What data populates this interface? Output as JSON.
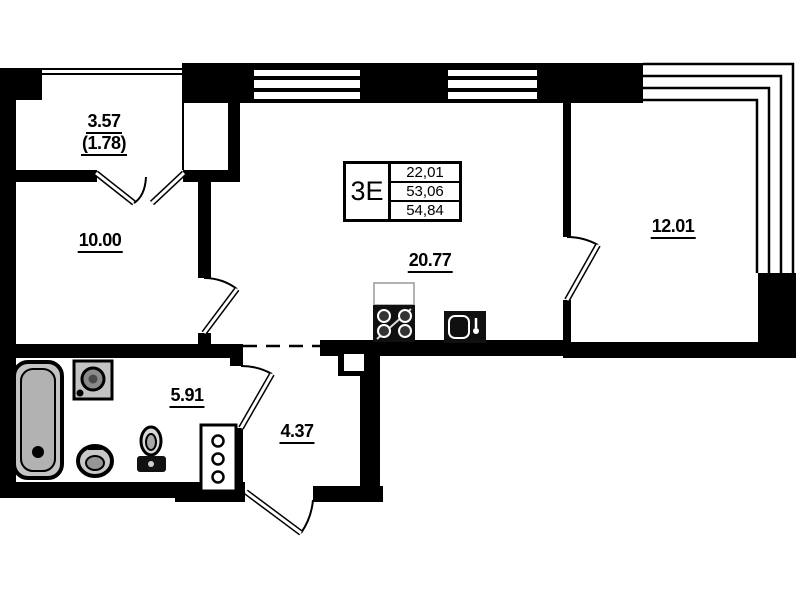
{
  "plan": {
    "title": "apartment-floor-plan",
    "unit_label": "3Е",
    "area_table": {
      "rows": [
        "22,01",
        "53,06",
        "54,84"
      ]
    },
    "rooms": [
      {
        "id": "balcony",
        "area": "3.57",
        "area_reduced": "(1.78)"
      },
      {
        "id": "bedroom-left",
        "area": "10.00"
      },
      {
        "id": "kitchen-living",
        "area": "20.77"
      },
      {
        "id": "bedroom-right",
        "area": "12.01"
      },
      {
        "id": "bathroom",
        "area": "5.91"
      },
      {
        "id": "hallway",
        "area": "4.37"
      }
    ],
    "fixtures": [
      "bathtub",
      "washing-machine",
      "washbasin",
      "toilet",
      "ventilation-shaft",
      "stove",
      "kitchen-sink"
    ],
    "colors": {
      "wall": "#000000",
      "background": "#ffffff",
      "fixture_fill": "#c4c4c4"
    }
  }
}
